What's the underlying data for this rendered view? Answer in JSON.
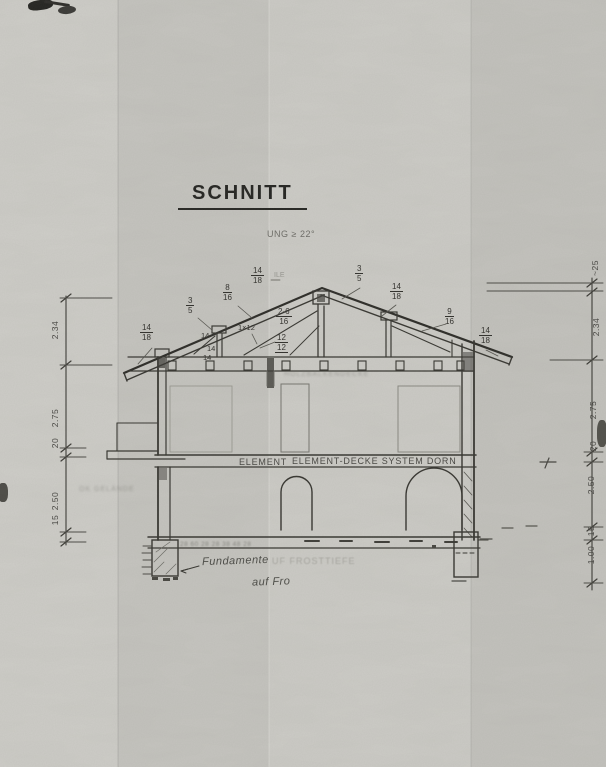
{
  "title": "SCHNITT",
  "notes": {
    "roof_pitch": "UNG ≥ 22°",
    "apex_suffix": "ILE",
    "attic_smudge": "HOLZBALKENDECKE",
    "terrain_smudge": "OK GELÄNDE",
    "footing_numbers": "28 60 28 28 38 48 28",
    "frost_faint": "UF FROSTTIEFE",
    "foundation_line1": "Fundamente",
    "foundation_line2": "auf Fro",
    "floor_left": "ELEMENT",
    "floor_main": "ELEMENT-DECKE  SYSTEM  DORN"
  },
  "fractions": [
    {
      "num": "14",
      "den": "18"
    },
    {
      "num": "3",
      "den": "5"
    },
    {
      "num": "8",
      "den": "16"
    },
    {
      "num": "14",
      "den": "18"
    },
    {
      "num": "3",
      "den": "5"
    },
    {
      "num": "14",
      "den": "18"
    },
    {
      "num": "9",
      "den": "16"
    },
    {
      "num": "14",
      "den": "18"
    },
    {
      "num": "2-6",
      "den": "16"
    },
    {
      "num": "12",
      "den": "12"
    }
  ],
  "labels": {
    "board": "1×12",
    "k14a": "14",
    "k14b": "14",
    "k14c": "14"
  },
  "dims_left": [
    "2.34",
    "2.75",
    "20",
    "2.50",
    "15"
  ],
  "dims_right": [
    "~25",
    "2.34",
    "2.75",
    "20",
    "2.50",
    "15",
    "1.00"
  ]
}
